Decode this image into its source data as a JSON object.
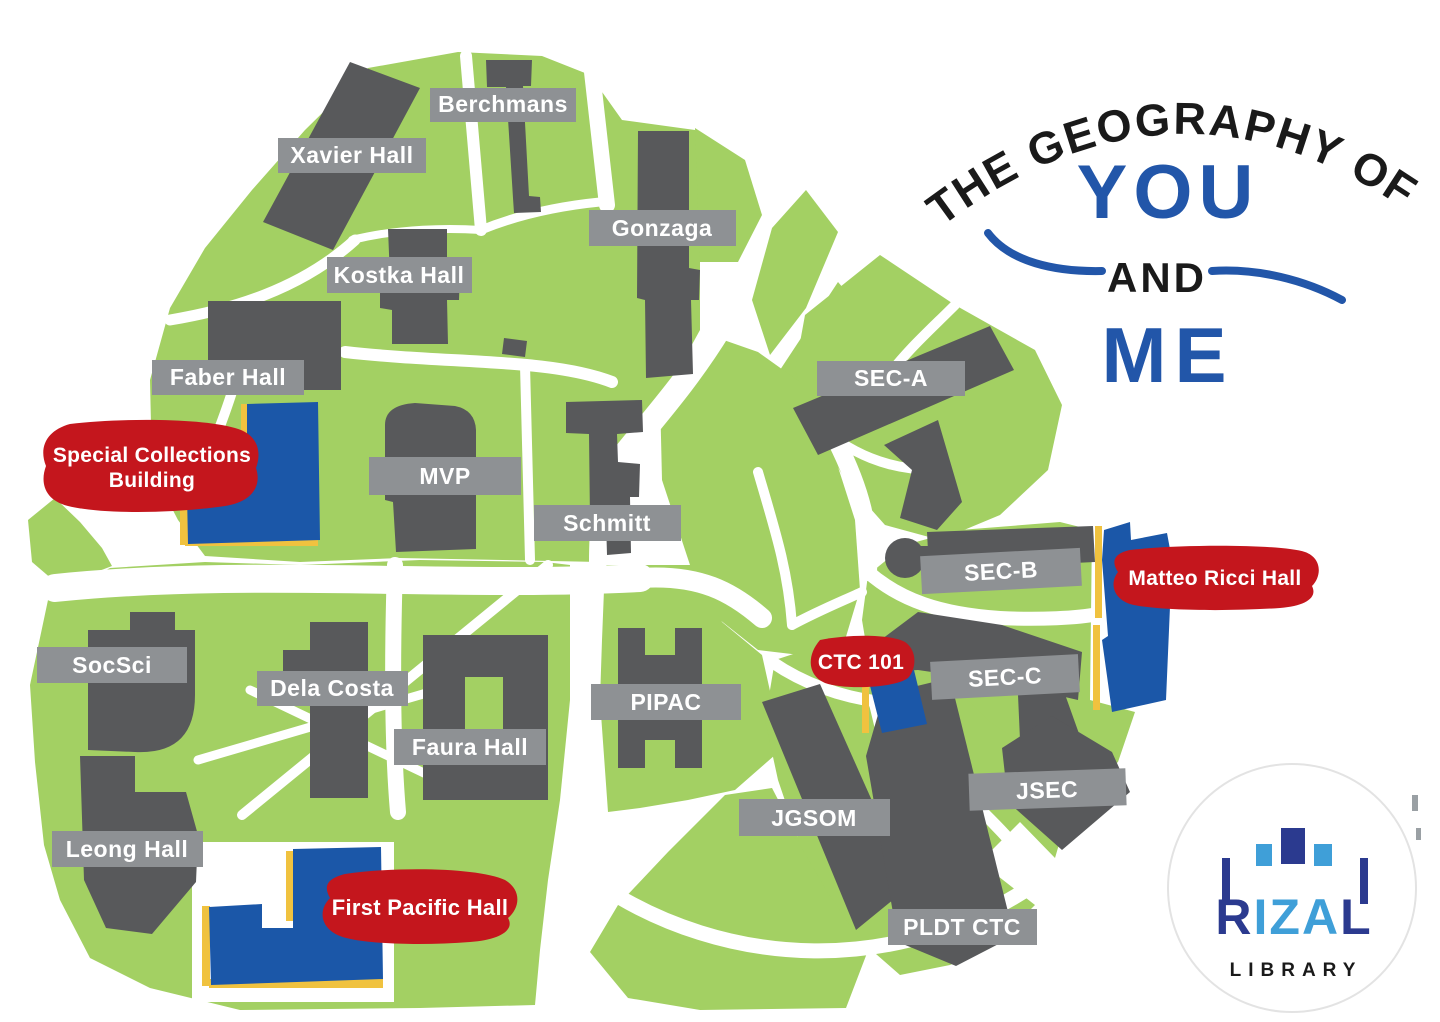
{
  "colors": {
    "map_green": "#a3d063",
    "building_gray": "#58595b",
    "chip_gray": "#8e9194",
    "highlight_red": "#c4161d",
    "highlight_blue": "#1b57a8",
    "accent_yellow": "#f0c23f",
    "road_white": "#ffffff",
    "title_blue": "#2256a9",
    "title_black": "#1a1a1a",
    "logo_dark_blue": "#2b3a8f",
    "logo_light_blue": "#3f9fd8"
  },
  "title": {
    "arc_text": "THE GEOGRAPHY OF",
    "you": "YOU",
    "and": "AND",
    "me": "ME"
  },
  "building_labels": [
    {
      "id": "berchmans",
      "text": "Berchmans"
    },
    {
      "id": "xavier-hall",
      "text": "Xavier Hall"
    },
    {
      "id": "gonzaga",
      "text": "Gonzaga"
    },
    {
      "id": "kostka-hall",
      "text": "Kostka Hall"
    },
    {
      "id": "faber-hall",
      "text": "Faber Hall"
    },
    {
      "id": "mvp",
      "text": "MVP"
    },
    {
      "id": "schmitt",
      "text": "Schmitt"
    },
    {
      "id": "sec-a",
      "text": "SEC-A"
    },
    {
      "id": "sec-b",
      "text": "SEC-B"
    },
    {
      "id": "sec-c",
      "text": "SEC-C"
    },
    {
      "id": "socsci",
      "text": "SocSci"
    },
    {
      "id": "dela-costa",
      "text": "Dela Costa"
    },
    {
      "id": "pipac",
      "text": "PIPAC"
    },
    {
      "id": "faura-hall",
      "text": "Faura Hall"
    },
    {
      "id": "jsec",
      "text": "JSEC"
    },
    {
      "id": "jgsom",
      "text": "JGSOM"
    },
    {
      "id": "leong-hall",
      "text": "Leong Hall"
    },
    {
      "id": "pldt-ctc",
      "text": "PLDT CTC"
    }
  ],
  "highlight_labels": {
    "special_collections": {
      "line1": "Special Collections",
      "line2": "Building"
    },
    "matteo_ricci": {
      "text": "Matteo Ricci Hall"
    },
    "ctc_101": {
      "text": "CTC 101"
    },
    "first_pacific": {
      "text": "First Pacific Hall"
    }
  },
  "logo": {
    "l1": "R",
    "l2": "I",
    "l3": "Z",
    "l4": "A",
    "l5": "L",
    "subtitle": "LIBRARY"
  }
}
